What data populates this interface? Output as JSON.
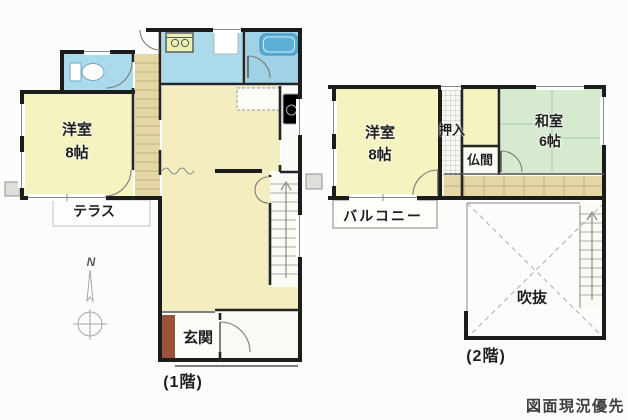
{
  "floor1": {
    "floor_label": "(1階)",
    "western_room_label": "洋室",
    "western_room_size": "8帖",
    "terrace_label": "テラス",
    "entrance_label": "玄関"
  },
  "floor2": {
    "floor_label": "(2階)",
    "western_room_label": "洋室",
    "western_room_size": "8帖",
    "japanese_room_label": "和室",
    "japanese_room_size": "6帖",
    "closet_label": "押入",
    "altar_room_label": "仏間",
    "balcony_label": "バルコニー",
    "atrium_label": "吹抜"
  },
  "compass": {
    "north_label": "N"
  },
  "footer_note": "図面現況優先",
  "colors": {
    "room_yellow": "#f5f3c0",
    "ldk_cream": "#f3edc0",
    "wet_blue": "#abdaeb",
    "bath_blue": "#9fd2e4",
    "tub_blue": "#5cb0d6",
    "tatami_green": "#d6ead0",
    "wood_tan": "#e4d7a6",
    "entrance_brown": "#9a5338",
    "wall_black": "#1c1c1c"
  }
}
